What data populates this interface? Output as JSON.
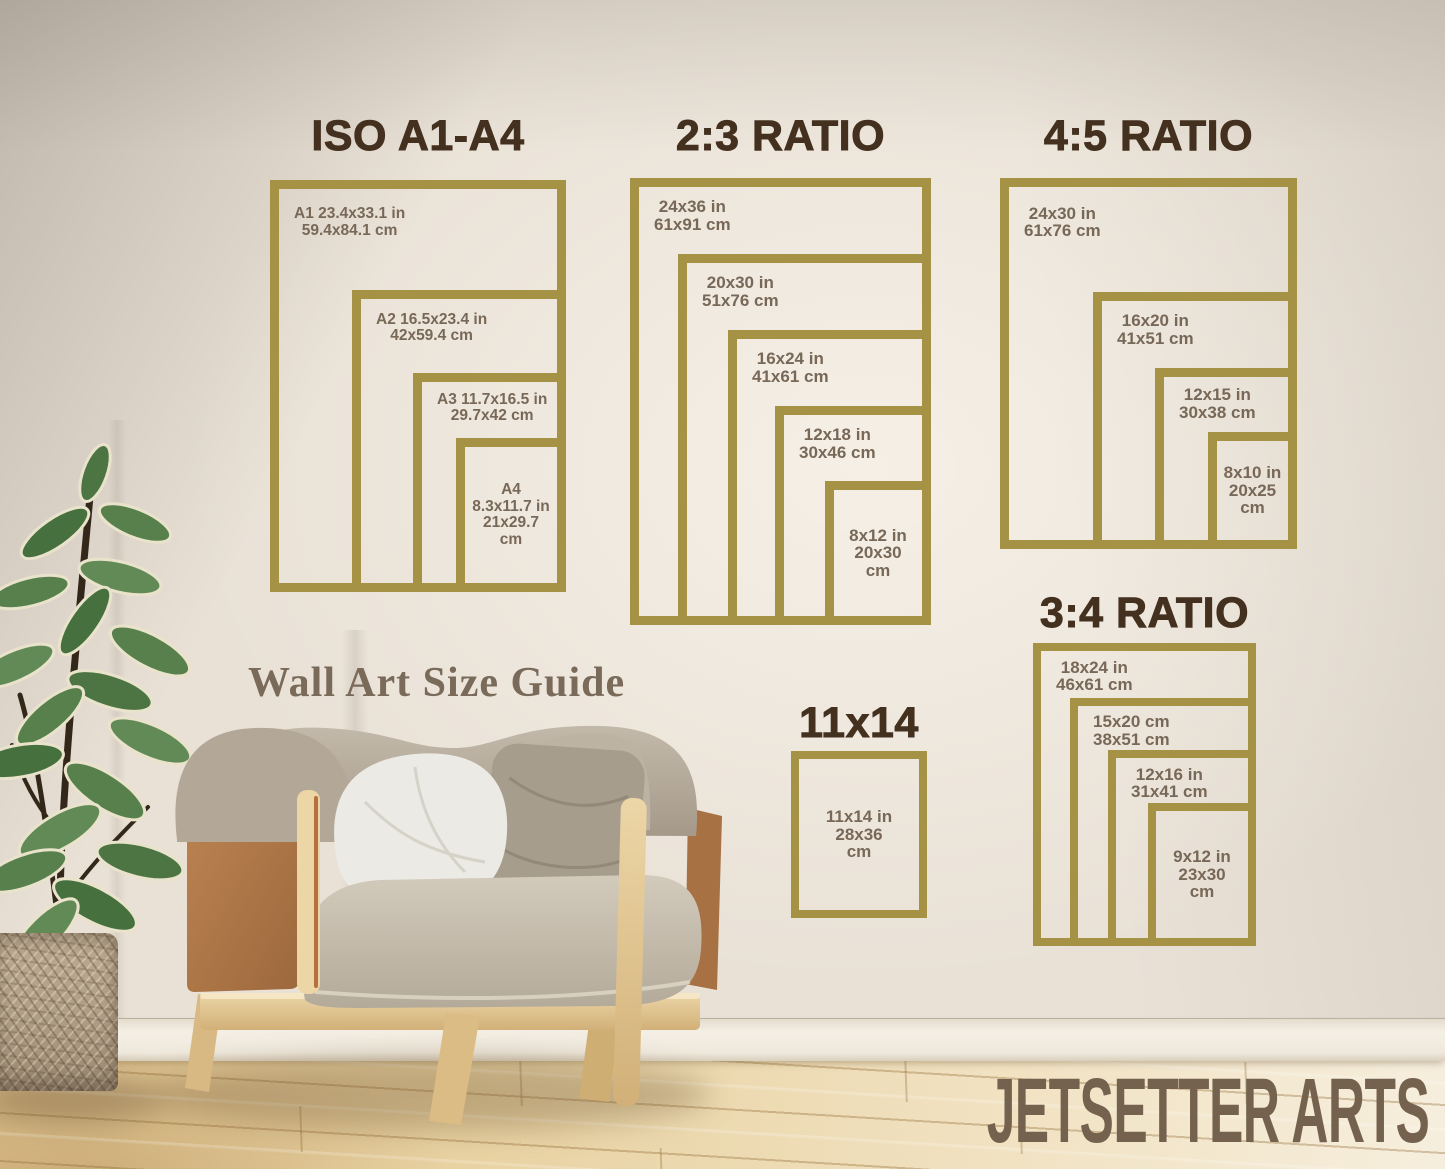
{
  "caption": {
    "text": "Wall Art Size Guide"
  },
  "brand": {
    "text": "JETSETTER ARTS"
  },
  "colors": {
    "frame_gold": "#a59245",
    "title_brown": "#44301f",
    "label_brown": "#786858",
    "caption_brown": "#7a6a5a",
    "brand_brown": "#74624f"
  },
  "panels": [
    {
      "id": "iso",
      "title": "ISO A1-A4",
      "frames": [
        {
          "lines": [
            "A1 23.4x33.1 in",
            "59.4x84.1 cm"
          ]
        },
        {
          "lines": [
            "A2 16.5x23.4 in",
            "42x59.4 cm"
          ]
        },
        {
          "lines": [
            "A3 11.7x16.5 in",
            "29.7x42 cm"
          ]
        },
        {
          "lines": [
            "A4",
            "8.3x11.7 in",
            "21x29.7",
            "cm"
          ]
        }
      ]
    },
    {
      "id": "r23",
      "title": "2:3 RATIO",
      "frames": [
        {
          "lines": [
            "24x36 in",
            "61x91 cm"
          ]
        },
        {
          "lines": [
            "20x30 in",
            "51x76 cm"
          ]
        },
        {
          "lines": [
            "16x24 in",
            "41x61 cm"
          ]
        },
        {
          "lines": [
            "12x18 in",
            "30x46 cm"
          ]
        },
        {
          "lines": [
            "8x12 in",
            "20x30",
            "cm"
          ]
        }
      ]
    },
    {
      "id": "r45",
      "title": "4:5 RATIO",
      "frames": [
        {
          "lines": [
            "24x30 in",
            "61x76 cm"
          ]
        },
        {
          "lines": [
            "16x20 in",
            "41x51 cm"
          ]
        },
        {
          "lines": [
            "12x15 in",
            "30x38 cm"
          ]
        },
        {
          "lines": [
            "8x10 in",
            "20x25",
            "cm"
          ]
        }
      ]
    },
    {
      "id": "r34",
      "title": "3:4 RATIO",
      "frames": [
        {
          "lines": [
            "18x24 in",
            "46x61 cm"
          ]
        },
        {
          "lines": [
            "15x20 cm",
            "38x51 cm"
          ]
        },
        {
          "lines": [
            "12x16 in",
            "31x41 cm"
          ]
        },
        {
          "lines": [
            "9x12 in",
            "23x30",
            "cm"
          ]
        }
      ]
    },
    {
      "id": "s1114",
      "title": "11x14",
      "frames": [
        {
          "lines": [
            "11x14 in",
            "28x36",
            "cm"
          ]
        }
      ]
    }
  ]
}
